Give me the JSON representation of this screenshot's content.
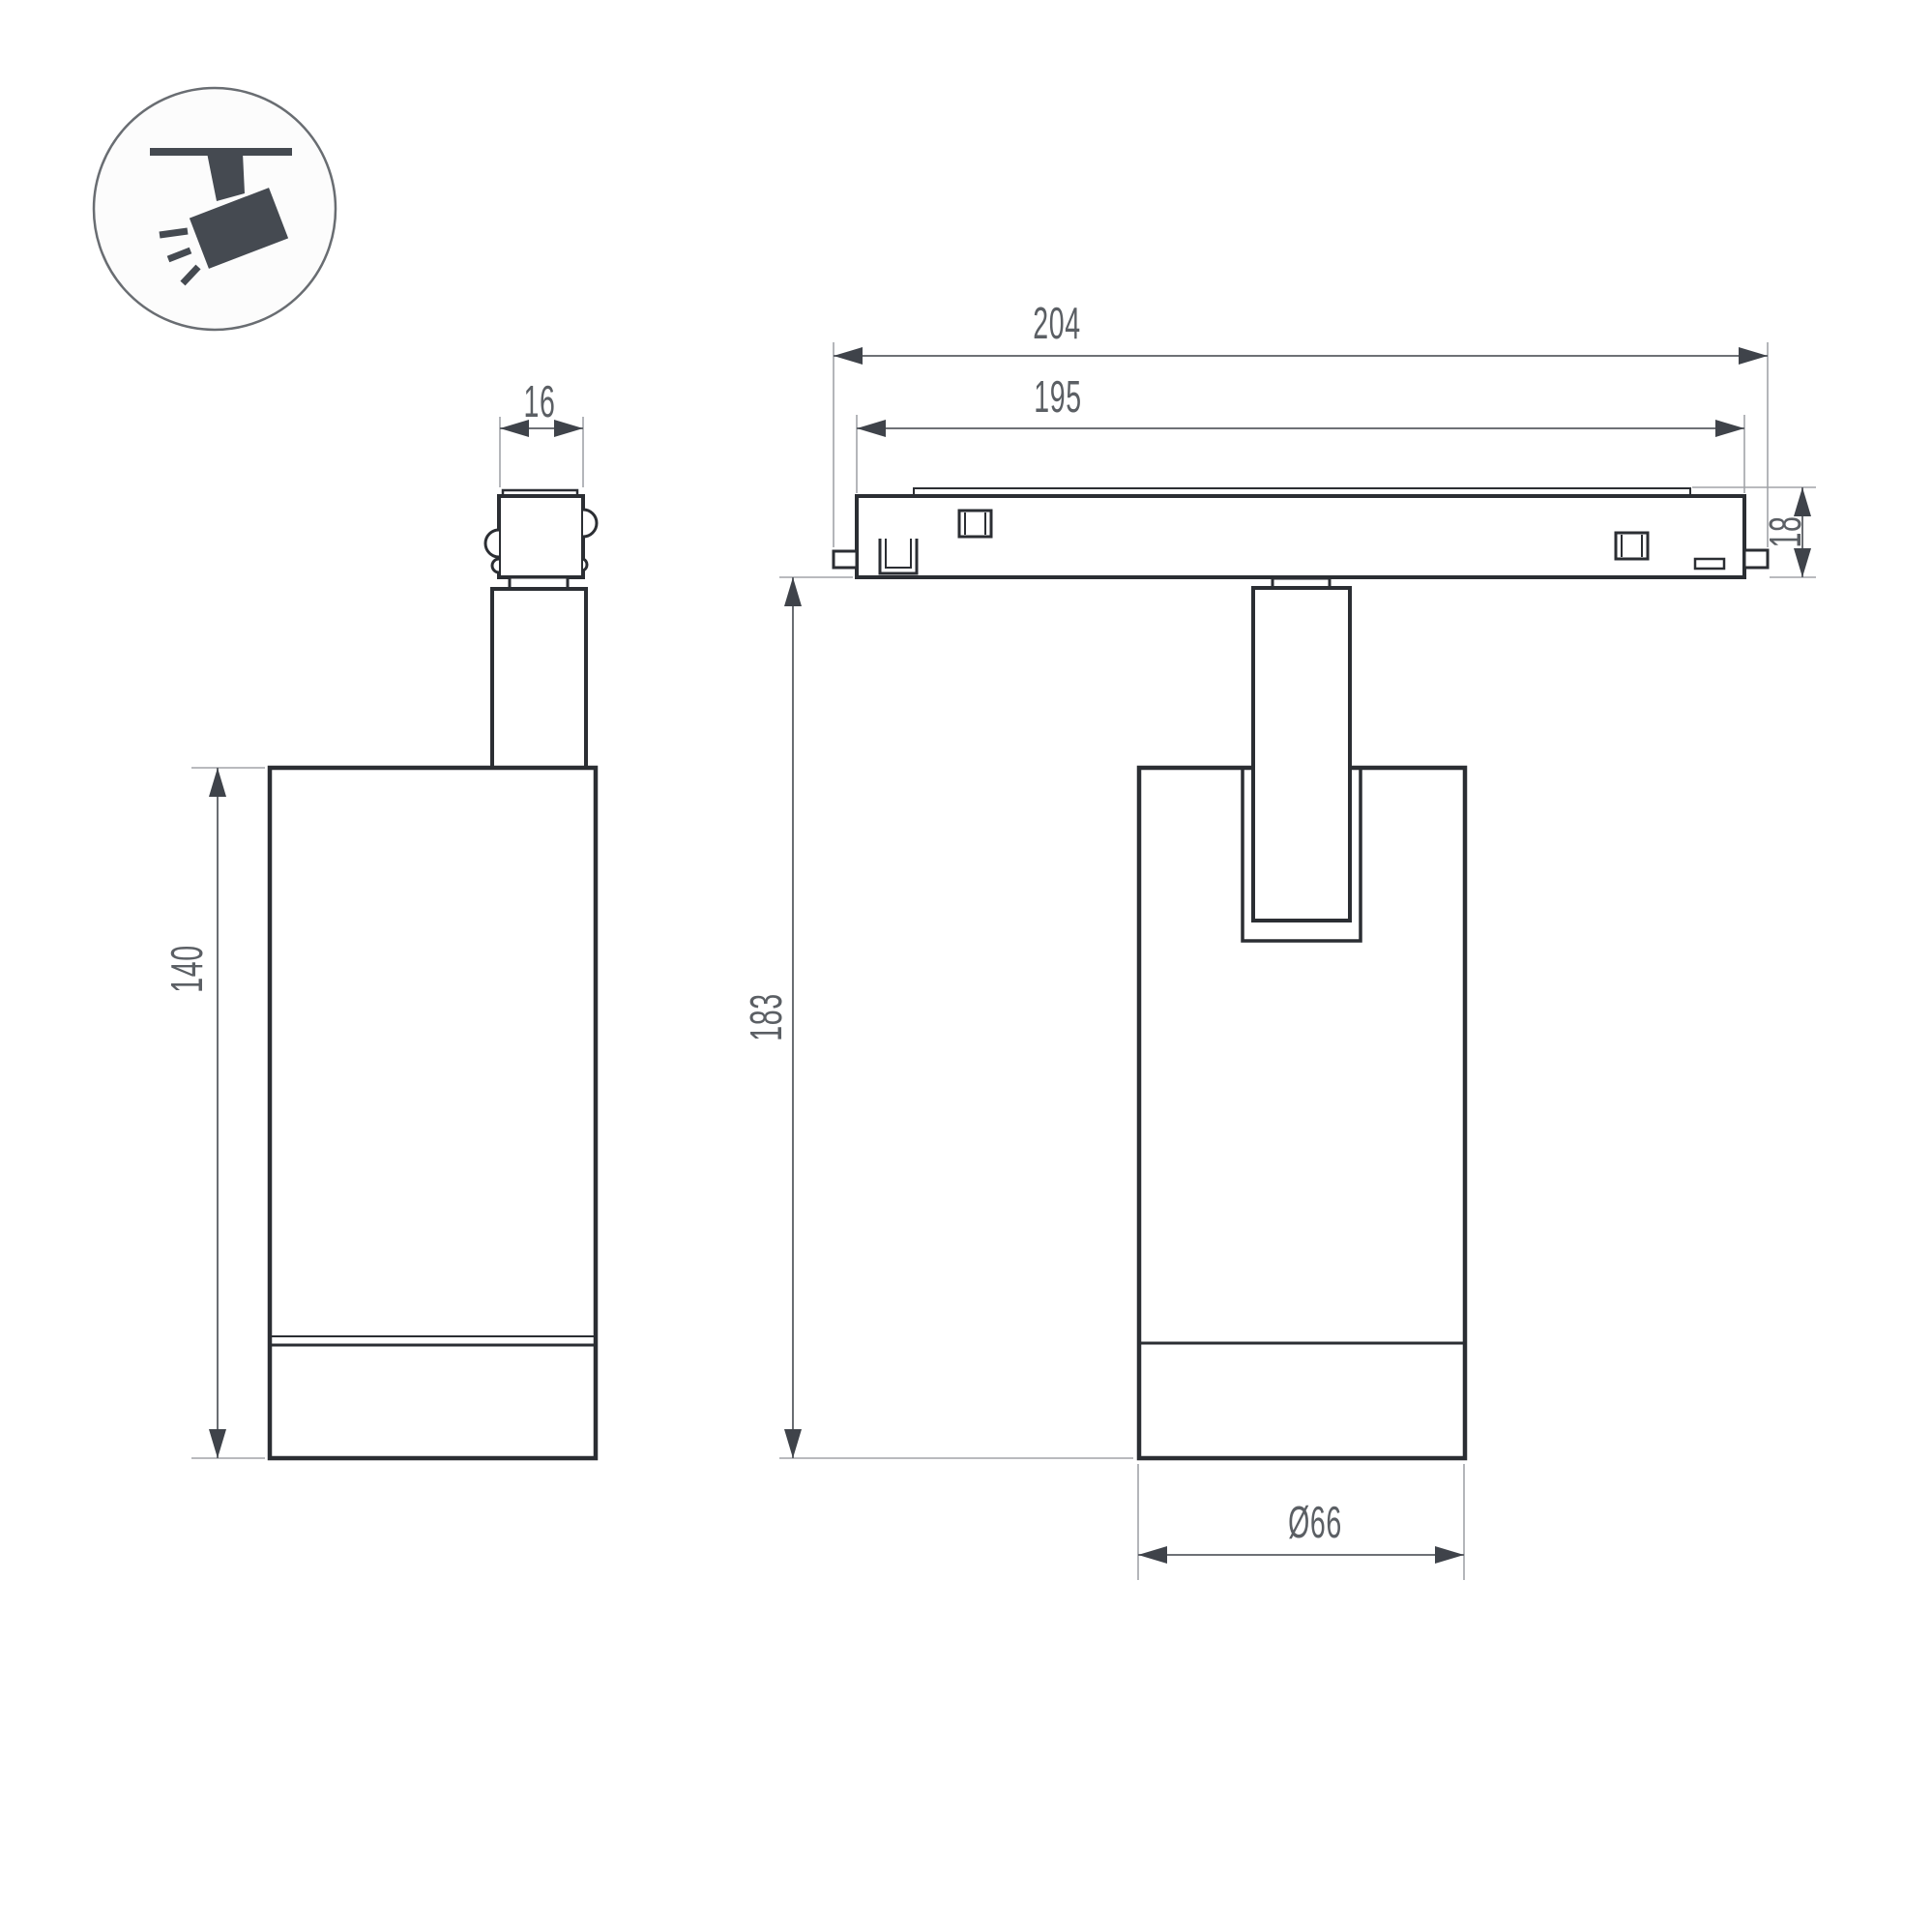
{
  "drawing": {
    "kind": "technical dimension drawing",
    "views": [
      "side view of track spotlight",
      "front view of track spotlight on magnetic track"
    ]
  },
  "icon": {
    "name": "track-spotlight-icon",
    "description": "ceiling-track spotlight pictogram in a circle"
  },
  "dimensions": {
    "adapter_width": {
      "label": "16"
    },
    "body_height_side": {
      "label": "140"
    },
    "track_overall_length": {
      "label": "204"
    },
    "track_body_length": {
      "label": "195"
    },
    "track_height": {
      "label": "18"
    },
    "fixture_height": {
      "label": "183"
    },
    "body_diameter": {
      "label": "Ø66"
    }
  },
  "colors": {
    "background": "#ffffff",
    "outline": "#2b2e33",
    "dimension_line": "#595d63",
    "extension_line": "#a2a4a8",
    "arrowhead": "#3f434a",
    "text": "#5b5f64",
    "icon_glyph": "#454a51",
    "icon_circle_stroke": "#696d72"
  }
}
